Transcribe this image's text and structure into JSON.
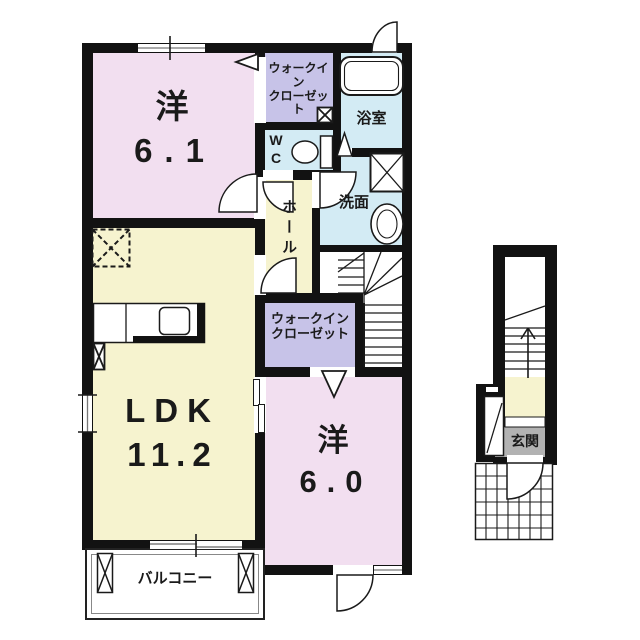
{
  "colors": {
    "wall": "#121212",
    "line": "#1a1a1a",
    "room_pink": "#f2dff0",
    "room_yellow": "#f6f3cf",
    "room_lavender": "#c7c3e8",
    "room_blue": "#d3ebf4",
    "genkan_gray": "#b2b2b2",
    "background": "#ffffff"
  },
  "rooms": {
    "bedroom1": {
      "label": "洋",
      "area": "6.1"
    },
    "ldk": {
      "label": "LDK",
      "area": "11.2"
    },
    "bedroom2": {
      "label": "洋",
      "area": "6.0"
    },
    "walkin_closet_upper": {
      "line1": "ウォークイン",
      "line2": "クローゼット"
    },
    "walkin_closet_lower": {
      "line1": "ウォークイン",
      "line2": "クローゼット"
    },
    "toilet": {
      "line1": "W",
      "line2": "C"
    },
    "bathroom": {
      "label": "浴室"
    },
    "washroom": {
      "label": "洗面"
    },
    "hall": {
      "label": "ホール"
    },
    "balcony": {
      "label": "バルコニー"
    },
    "entrance": {
      "label": "玄関"
    }
  }
}
